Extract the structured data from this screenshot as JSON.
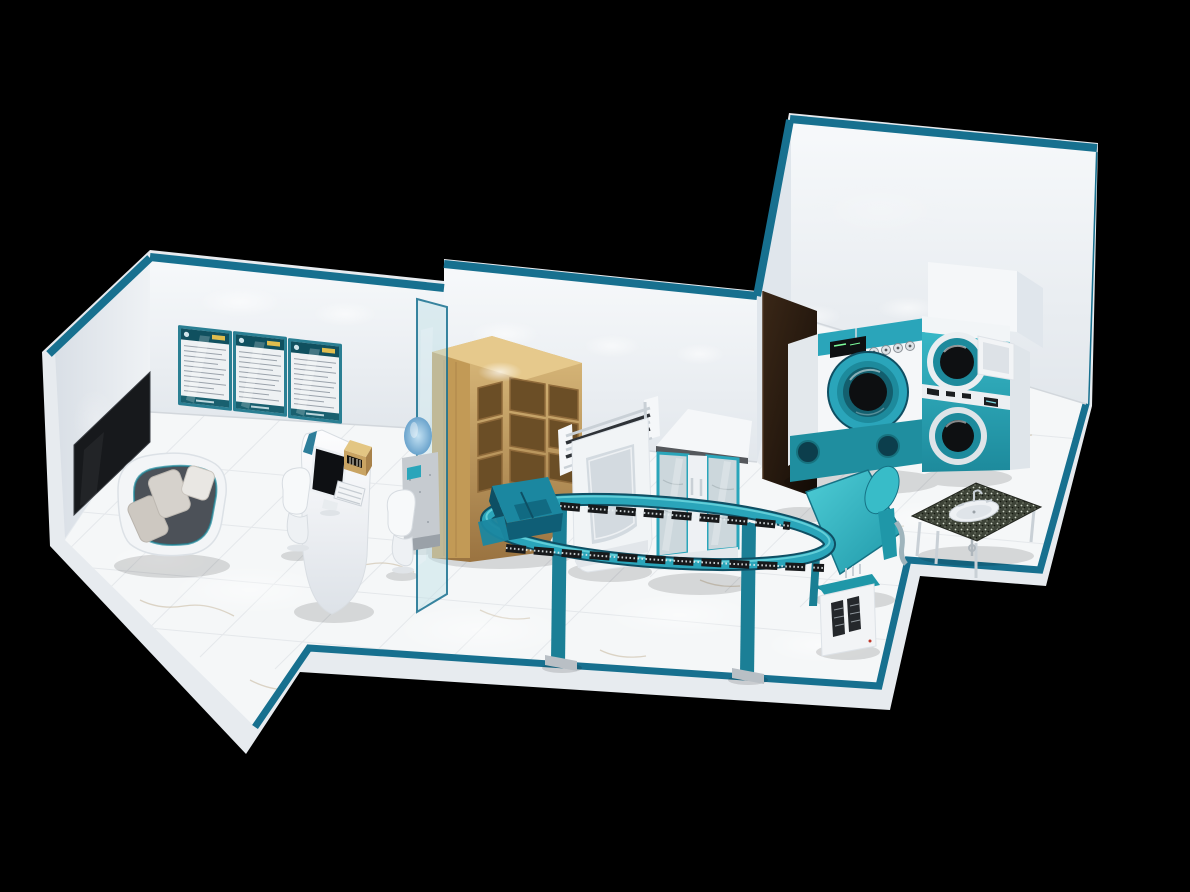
{
  "scene": {
    "title": "3D isometric render of a laundry and dry-cleaning shop interior",
    "description": "Bird's-eye axonometric cutaway of a teal-and-white laundry shop on a black background. Reception area with wall menu board, three framed service posters, white pod sofa, curved POS desk with monitor, gold cash register and keyboard, two white chairs and a water dispenser behind a teal glass partition. Storage zone with a wooden corner shelf, chrome drying rack, white steam cabinet and a teal-framed glass display cabinet. Work zone with an oval garment conveyor rail, industrial dry-cleaning machine, stacked washer-dryer with open door, granite-top wash basin and a teal ironing/finishing table with vacuum unit.",
    "view": "axonometric top-down cutaway",
    "background": "#000000"
  },
  "palette": {
    "background": "#000000",
    "slab": "#e7ebef",
    "wall_face": "#f1f4f7",
    "wall_face_dark": "#e0e6ec",
    "wall_trim": "#17708f",
    "accent_teal": "#2aa5ba",
    "teal_mid": "#1d8a9c",
    "teal_dark": "#0f4f63",
    "teal_bright": "#3fc4cf",
    "floor": "#f5f7f8",
    "tile_line": "#dce0e4",
    "vein": "#c2b092",
    "wood": "#cfa763",
    "wood_dark": "#6b4e26",
    "door_brown": "#2b1c10",
    "glass": "#bfdfe6",
    "gold": "#c9a463",
    "granite": "#3e4438",
    "chrome": "#c9d0d6",
    "screen_black": "#0e1013",
    "seat_dark": "#4c5158",
    "cushion": "#cdc8c1",
    "white": "#f5f7f9"
  },
  "areas": {
    "reception": {
      "label": "Reception and waiting area",
      "items": [
        "menu board",
        "3 framed posters",
        "pod sofa",
        "POS desk",
        "2 guest chairs",
        "water dispenser",
        "glass partition"
      ]
    },
    "storage": {
      "label": "Garment storage zone",
      "items": [
        "wooden corner shelf",
        "chrome drying rack",
        "steam cabinet",
        "glass display cabinet"
      ]
    },
    "workroom": {
      "label": "Machine and finishing room",
      "items": [
        "garment conveyor",
        "dry-cleaning machine",
        "stacked washer-dryer",
        "granite wash basin",
        "ironing table with vacuum unit",
        "open service door"
      ]
    }
  },
  "objects": {
    "menu_board": {
      "label": "Wall-mounted menu board / TV, screen off",
      "screen_color": "#17191c"
    },
    "certificates": {
      "label": "Framed service posters with teal frames",
      "count": 3,
      "header_color": "#10505f",
      "badge_color": "#e0bd4e"
    },
    "sofa": {
      "label": "White pod sofa with dark seat",
      "cushions": 2,
      "pillows": 1
    },
    "reception_desk": {
      "label": "Curved white POS counter",
      "equipment": [
        "monitor",
        "gold cash register",
        "keyboard",
        "mouse"
      ]
    },
    "guest_chairs": {
      "label": "White cantilever chairs",
      "count": 2
    },
    "water_dispenser": {
      "label": "Bottled water dispenser",
      "bottle_color": "#7fb6d9"
    },
    "glass_partition": {
      "label": "Teal tinted glass partition"
    },
    "corner_shelf": {
      "label": "L-shaped wooden cubby shelf",
      "cubbies": 9
    },
    "drying_rack": {
      "label": "Chrome garment drying rack",
      "bars": 4
    },
    "steam_cabinet": {
      "label": "White steam cabinet with arched recess"
    },
    "display_cabinet": {
      "label": "Glass-door cabinet with teal frames",
      "doors": 2
    },
    "garment_conveyor": {
      "label": "Oval garment conveyor rail with hanger slats",
      "legs": 2,
      "loading_station": true
    },
    "dry_cleaning_machine": {
      "label": "Industrial dry-cleaning machine",
      "knobs": 4,
      "base_ports": 2,
      "drum": "closed"
    },
    "stacked_washer_dryer": {
      "label": "Stacked washer-dryer tower",
      "drums": 2,
      "top_door": "open"
    },
    "service_door": {
      "label": "Open dark-brown service door"
    },
    "sink_table": {
      "label": "Granite-top wash basin on chrome legs",
      "legs": 4
    },
    "ironing_station": {
      "label": "Teal ironing/finishing table with sleeve arm",
      "vacuum_vents": 2
    },
    "entrance_strip": {
      "label": "Teal floor border along storefront edge"
    }
  }
}
